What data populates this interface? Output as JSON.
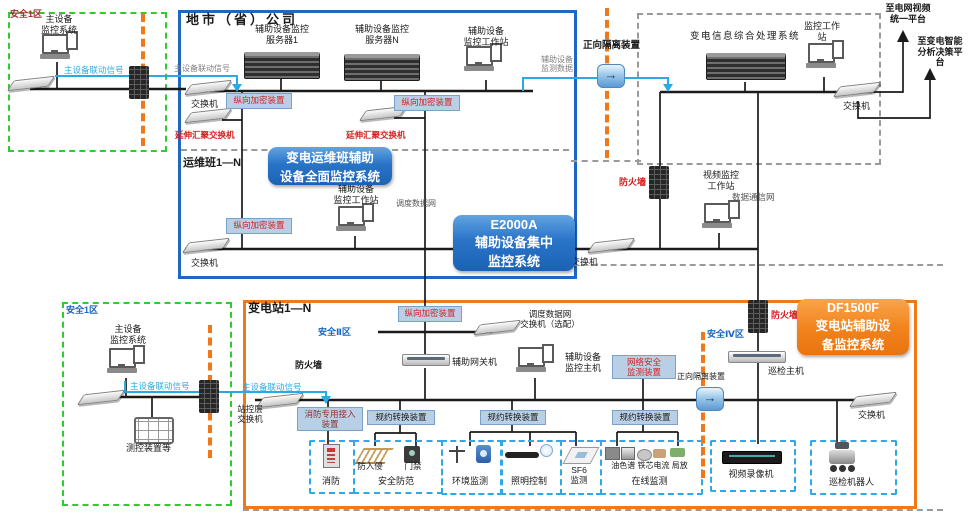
{
  "colors": {
    "company_border": "#2066c4",
    "substation_border": "#ee7a1c",
    "security_zone_border": "#2ecc2e",
    "boundary_dash": "#f07818",
    "badge_blue": "#1b62b4",
    "badge_orange": "#ef7c12",
    "red_text": "#d42020",
    "signal_blue": "#29abe2"
  },
  "zone_a": {
    "label": "安全1区",
    "system": "主设备\n监控系统",
    "signal": "主设备联动信号"
  },
  "company": {
    "title": "地市（省）公司",
    "server1": "辅助设备监控\n服务器1",
    "serverN": "辅助设备监控\n服务器N",
    "workstation": "辅助设备\n监控工作站",
    "linkage_signal": "主设备联动信号",
    "switch_label": "交换机",
    "encryptor": "纵向加密装置",
    "agg_switch": "延伸汇聚交换机",
    "ops_title": "运维班1—N",
    "ops_workstation": "辅助设备\n监控工作站",
    "ops_switch": "交换机",
    "dispatch_net": "调度数据网"
  },
  "badges": {
    "ops": "变电运维班辅助\n设备全面监控系统",
    "e2000a": "E2000A\n辅助设备集中\n监控系统",
    "df1500f": "DF1500F\n变电站辅助设\n备监控系统"
  },
  "head_office": {
    "info_system": "变电信息综合处理系统",
    "workstation": "监控工作\n站",
    "switch_label": "交换机",
    "to_video_platform": "至电网视频\n统一平台",
    "to_analysis_platform": "至变电智能\n分析决策平\n台",
    "isolation": "正向隔离装置",
    "aux_data": "辅助设备\n监测数据",
    "firewall": "防火墙",
    "video_workstation": "视频监控\n工作站",
    "data_network": "数据通信网",
    "switch2_label": "交换机"
  },
  "substation": {
    "title": "变电站1—N",
    "encryptor": "纵向加密装置",
    "zone2": "安全Ⅱ区",
    "zone4": "安全Ⅳ区",
    "dispatch_switch": "调度数据网\n交换机（选配）",
    "firewall_label": "防火墙",
    "gateway": "辅助网关机",
    "host": "辅助设备\n监控主机",
    "netsec": "网络安全\n监测装置",
    "isolation": "正向隔离装置",
    "firewall_right": "防火墙",
    "patrol_host": "巡检主机",
    "switch_right": "交换机",
    "linkage_signal": "主设备联动信号",
    "station_switch": "站控层\n交换机",
    "fire_access": "消防专用接入\n装置",
    "protocol_converter": "规约转换装置",
    "groups": {
      "fire": "消防",
      "security": "安全防范",
      "anti_intrusion": "防入侵",
      "access_control": "门禁",
      "environment": "环境监测",
      "lighting": "照明控制",
      "sf6": "SF6\n监测",
      "online": "在线监测",
      "online_items": "油色谱 铁芯电流 局放",
      "vcr": "视频录像机",
      "robot": "巡检机器人"
    }
  },
  "zone_b": {
    "label": "安全1区",
    "system": "主设备\n监控系统",
    "signal": "主设备联动信号",
    "measure": "测控装置等"
  }
}
